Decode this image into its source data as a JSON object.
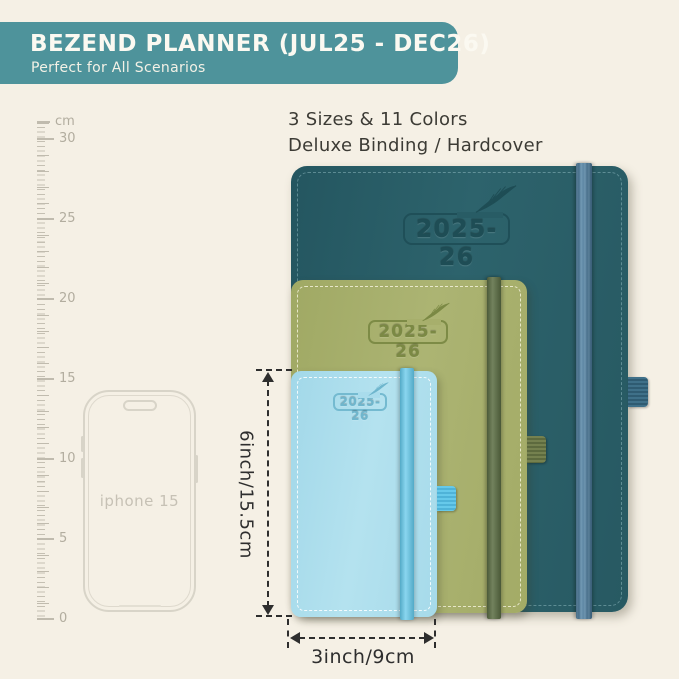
{
  "colors": {
    "background": "#f5f0e5",
    "banner": "#4e939b",
    "banner_text": "#fbf9f1",
    "body_text": "#3c3b35",
    "annotation": "#2e2e2e",
    "ruler_ticks": "#c0bbae",
    "phone_outline": "#d8d4c8"
  },
  "banner": {
    "title": "BEZEND PLANNER (JUL25 - DEC26)",
    "subtitle": "Perfect for All Scenarios"
  },
  "headline": {
    "line1": "3 Sizes & 11 Colors",
    "line2": "Deluxe Binding / Hardcover"
  },
  "ruler": {
    "unit": "cm",
    "labels": [
      "30",
      "25",
      "20",
      "15",
      "10",
      "5",
      "0"
    ]
  },
  "phone": {
    "label": "iphone 15"
  },
  "planners": [
    {
      "name": "large",
      "year": "2025-26",
      "cover_color": "#295d66",
      "band_color": "#5183a6",
      "logo_color": "#1e4d55"
    },
    {
      "name": "medium",
      "year": "2025-26",
      "cover_color": "#a6ae6b",
      "band_color": "#5f7147",
      "logo_color": "#7b8944"
    },
    {
      "name": "small",
      "year": "2025-26",
      "cover_color": "#a9dcec",
      "band_color": "#62c8ea",
      "logo_color": "#6fb6cd"
    }
  ],
  "dimensions": {
    "height_label": "6inch/15.5cm",
    "width_label": "3inch/9cm"
  },
  "icons": {
    "feather": "quill-feather"
  }
}
